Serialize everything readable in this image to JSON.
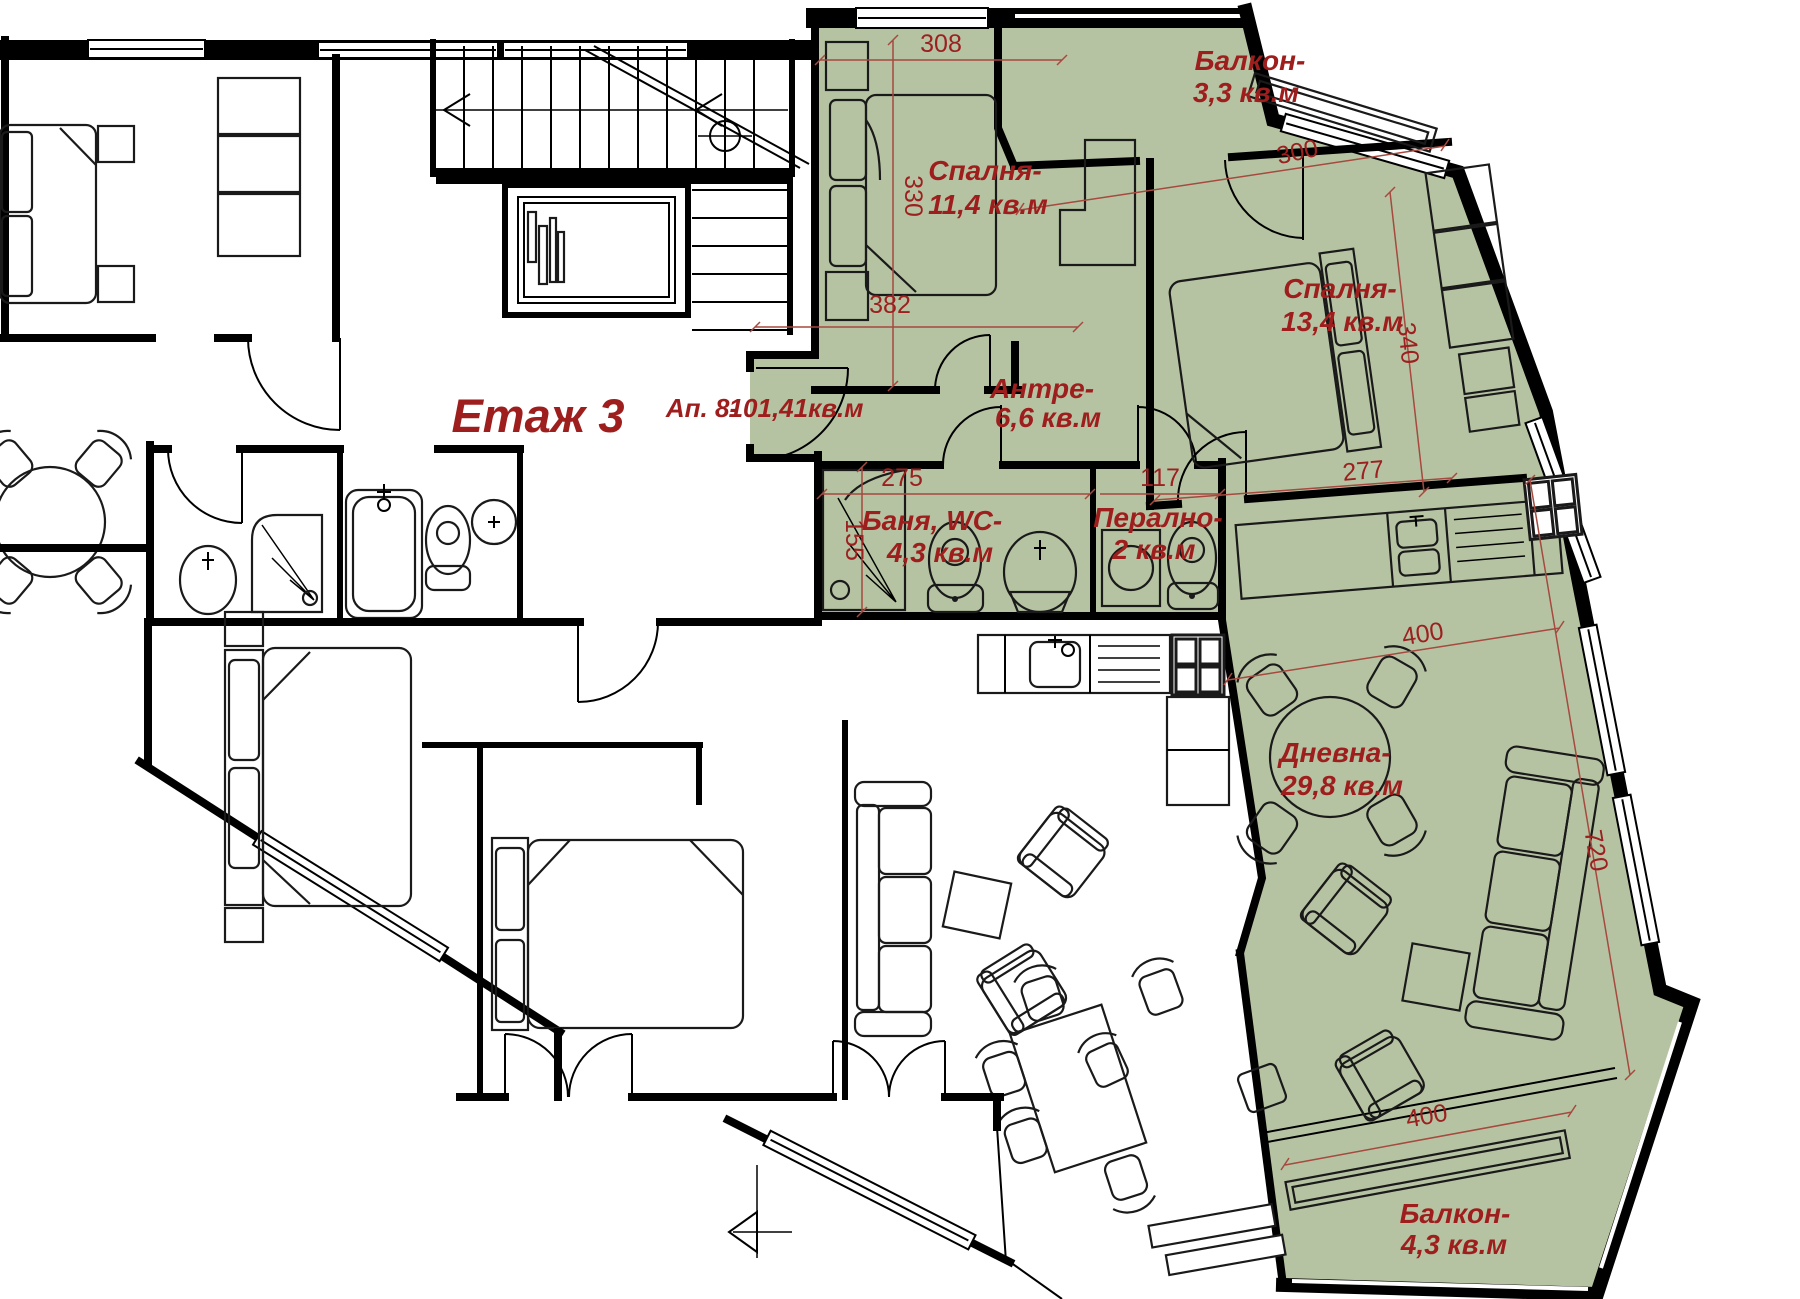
{
  "floor_label": "Етаж 3",
  "apartment": {
    "label": "Ап. 8-",
    "area": "101,41кв.м"
  },
  "rooms": {
    "bedroom_small": {
      "name": "Спалня-",
      "area": "11,4 кв.м"
    },
    "balcony_top": {
      "name": "Балкон-",
      "area": "3,3 кв.м"
    },
    "bedroom_large": {
      "name": "Спалня-",
      "area": "13,4 кв.м"
    },
    "antre": {
      "name": "Антре-",
      "area": "6,6 кв.м"
    },
    "bath": {
      "name": "Баня, WC-",
      "area": "4,3 кв.м"
    },
    "laundry": {
      "name": "Перално-",
      "area": "2 кв.м"
    },
    "living": {
      "name": "Дневна-",
      "area": "29,8 кв.м"
    },
    "balcony_bottom": {
      "name": "Балкон-",
      "area": "4,3 кв.м"
    }
  },
  "dims": {
    "d308": "308",
    "d330": "330",
    "d382": "382",
    "d300": "300",
    "d340": "340",
    "d277": "277",
    "d275": "275",
    "d117": "117",
    "d155": "155",
    "d400a": "400",
    "d720": "720",
    "d400b": "400"
  },
  "colors": {
    "highlight_green": "#b6c3a2",
    "label_red": "#9e1d1d",
    "dimension_red": "#a6493f",
    "wall_black": "#000000"
  }
}
